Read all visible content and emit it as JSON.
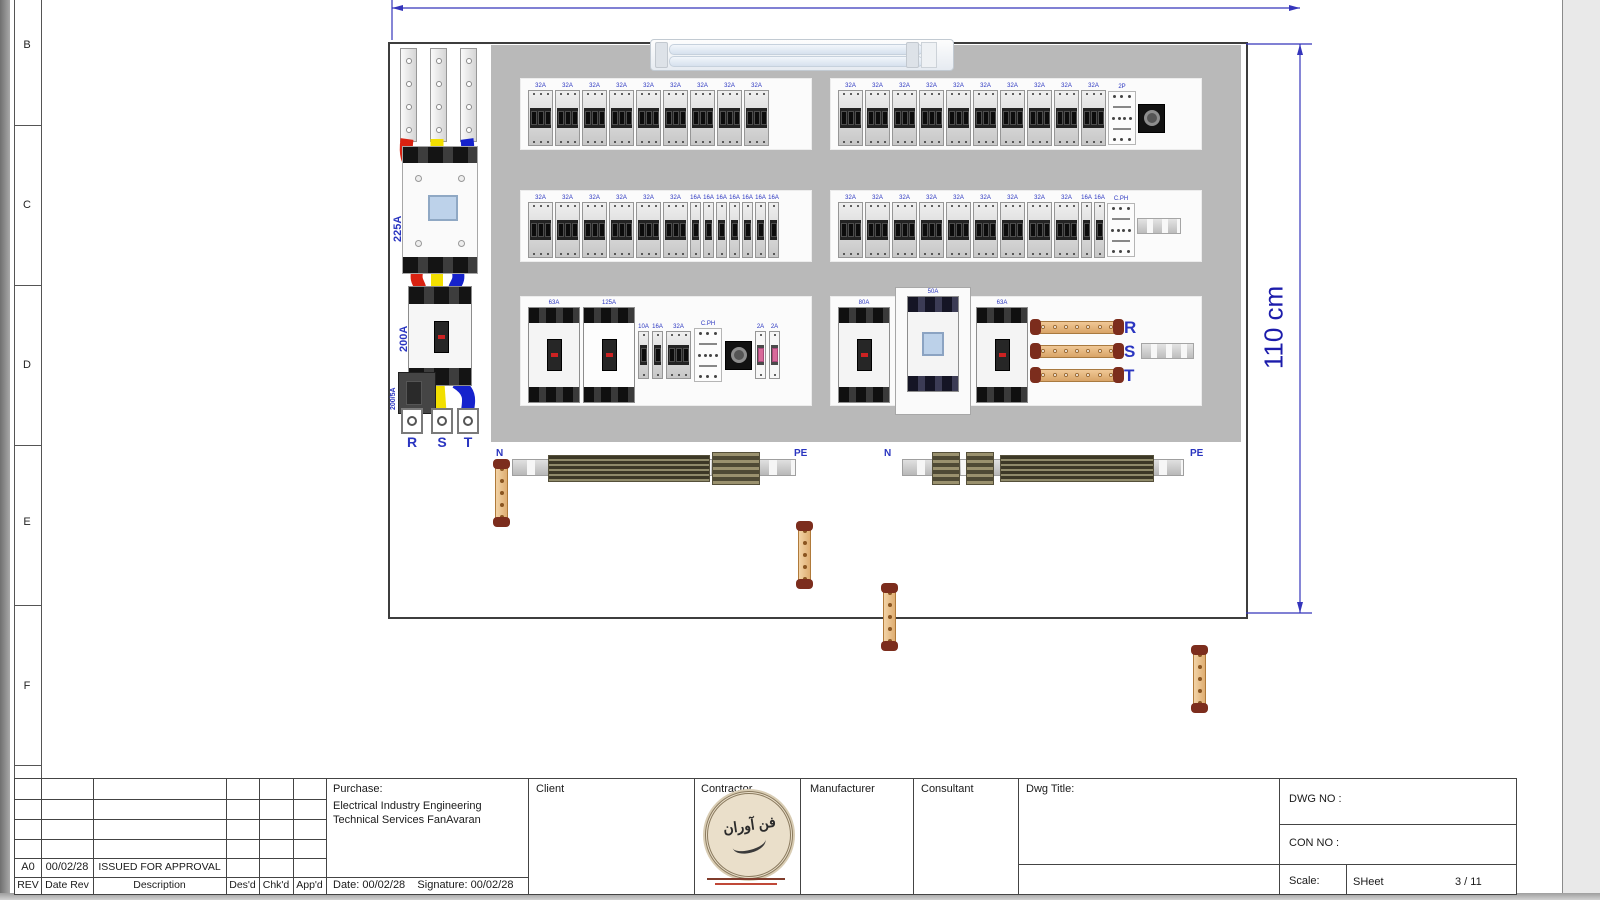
{
  "chrome": {
    "zone_letters": [
      "B",
      "C",
      "D",
      "E",
      "F"
    ]
  },
  "dimensions": {
    "height_label": "110 cm"
  },
  "colors": {
    "dimension_blue": "#1c1cab",
    "label_blue": "#2a35c0",
    "wire_red": "#d92211",
    "wire_yellow": "#f2df00",
    "wire_blue": "#1522cc",
    "copper": "#dfae72",
    "backplate_gray": "#b9b9b9"
  },
  "incomer": {
    "contactor_rating": "225A",
    "breaker_rating": "200A",
    "ct_rating": "200/5A",
    "phases": [
      "R",
      "S",
      "T"
    ]
  },
  "bus": {
    "n": "N",
    "pe": "PE"
  },
  "panel": {
    "groups": [
      {
        "id": "r1l",
        "items": [
          {
            "type": "mcb3",
            "label": "32A",
            "count": 9
          }
        ]
      },
      {
        "id": "r1r",
        "items": [
          {
            "type": "mcb3",
            "label": "32A",
            "count": 10
          },
          {
            "type": "cph",
            "label": "2P"
          },
          {
            "type": "timer"
          }
        ]
      },
      {
        "id": "r2l",
        "items": [
          {
            "type": "mcb3",
            "label": "32A",
            "count": 6
          },
          {
            "type": "mcb1",
            "label": "16A",
            "count": 7
          }
        ]
      },
      {
        "id": "r2r",
        "items": [
          {
            "type": "mcb3",
            "label": "32A",
            "count": 9
          },
          {
            "type": "mcb1",
            "label": "16A",
            "count": 2
          },
          {
            "type": "cph",
            "label": "C.PH"
          },
          {
            "type": "rail",
            "width": 44
          }
        ]
      },
      {
        "id": "r3l",
        "items": [
          {
            "type": "mccb",
            "label": "63A",
            "variant": "dark"
          },
          {
            "type": "mccb",
            "label": "125A",
            "variant": "light"
          },
          {
            "type": "mcb1",
            "label": "10A",
            "short": true
          },
          {
            "type": "mcb1",
            "label": "16A",
            "short": true
          },
          {
            "type": "mcb3",
            "label": "32A",
            "short": true
          },
          {
            "type": "cph",
            "label": "C.PH"
          },
          {
            "type": "timer"
          },
          {
            "type": "mcb1w",
            "label": "2A",
            "count": 2
          }
        ]
      },
      {
        "id": "r3r",
        "items": [
          {
            "type": "mccb",
            "label": "80A",
            "variant": "dark"
          },
          {
            "type": "mccb",
            "label": "50A",
            "variant": "contactor"
          },
          {
            "type": "mccb",
            "label": "63A",
            "variant": "dark"
          },
          {
            "type": "bus3",
            "labels": [
              "R",
              "S",
              "T"
            ]
          },
          {
            "type": "rail",
            "width": 55
          }
        ]
      }
    ]
  },
  "titleblock": {
    "rev_table": {
      "headers": [
        "REV",
        "Date Rev",
        "Description",
        "Des'd",
        "Chk'd",
        "App'd"
      ],
      "entry": {
        "rev": "A0",
        "date": "00/02/28",
        "description": "ISSUED FOR APPROVAL"
      }
    },
    "purchase": {
      "label": "Purchase:",
      "line1": "Electrical Industry Engineering",
      "line2": "Technical Services FanAvaran",
      "date_label": "Date:",
      "date_value": "00/02/28",
      "signature_label": "Signature:",
      "signature_value": "00/02/28"
    },
    "cells": {
      "client": "Client",
      "contractor": "Contractor",
      "manufacturer": "Manufacturer",
      "consultant": "Consultant",
      "dwg_title": "Dwg Title:"
    },
    "logo_text": "فن آوران",
    "right": {
      "dwg_no": "DWG NO :",
      "con_no": "CON NO :",
      "scale": "Scale:",
      "sheet": "SHeet",
      "page": "3 / 11"
    }
  }
}
